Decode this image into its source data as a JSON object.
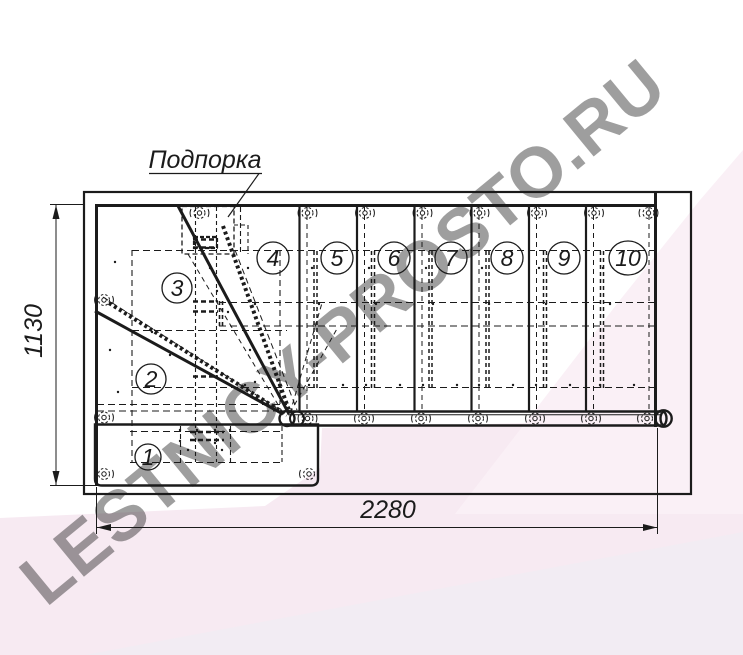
{
  "drawing_labels": {
    "support": "Подпорка"
  },
  "dimensions": {
    "width_mm": "2280",
    "height_mm": "1130"
  },
  "steps": [
    {
      "label": "1"
    },
    {
      "label": "2"
    },
    {
      "label": "3"
    },
    {
      "label": "4"
    },
    {
      "label": "5"
    },
    {
      "label": "6"
    },
    {
      "label": "7"
    },
    {
      "label": "8"
    },
    {
      "label": "9"
    },
    {
      "label": "10"
    }
  ],
  "watermark": {
    "text": "LESTNICY-PROSTO.RU"
  },
  "colors": {
    "line": "#1b1b1b",
    "pink_band": "#f7eaf2",
    "pink_wedge": "#faf0f6",
    "lavender": "#f2ecf3",
    "watermark": "#cfc2cb"
  }
}
